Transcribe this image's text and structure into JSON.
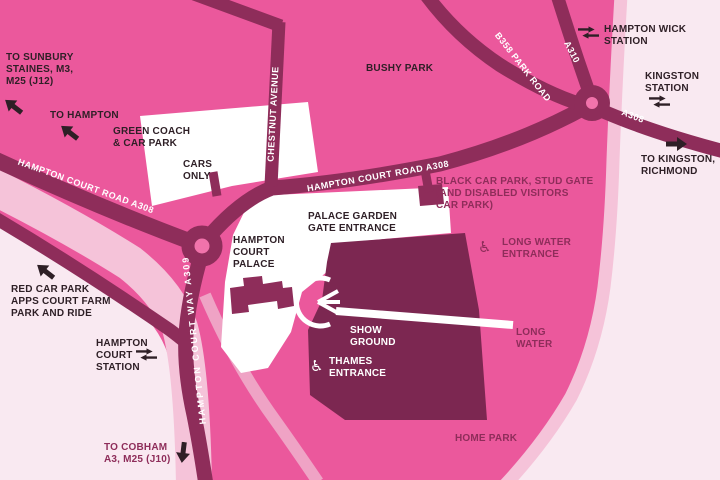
{
  "title": "Hampton Court Palace area map",
  "colors": {
    "pink": "#eb589c",
    "road": "#8e2d5a",
    "dark": "#7c2751",
    "lightband": "#f5c3d9",
    "medband": "#efa3c5",
    "verylight": "#f9e9f1",
    "rcenter": "#f173ab",
    "ink": "#2e1f26",
    "maroontext": "#8e2d5a"
  },
  "icons": {
    "wheelchair": "♿"
  },
  "labels": {
    "to_sunbury": {
      "l1": "TO SUNBURY",
      "l2": "STAINES, M3,",
      "l3": "M25 (J12)"
    },
    "to_hampton": {
      "l1": "TO HAMPTON"
    },
    "green_coach": {
      "l1": "GREEN COACH",
      "l2": "& CAR PARK"
    },
    "cars_only": {
      "l1": "CARS",
      "l2": "ONLY"
    },
    "bushy_park": {
      "l1": "BUSHY PARK"
    },
    "hampton_wick": {
      "l1": "HAMPTON WICK",
      "l2": "STATION"
    },
    "kingston_station": {
      "l1": "KINGSTON",
      "l2": "STATION"
    },
    "to_kingston": {
      "l1": "TO KINGSTON,",
      "l2": "RICHMOND"
    },
    "black_car_park": {
      "l1": "BLACK CAR PARK, STUD GATE",
      "l2": "(AND DISABLED VISITORS",
      "l3": "CAR PARK)"
    },
    "palace_garden": {
      "l1": "PALACE GARDEN",
      "l2": "GATE ENTRANCE"
    },
    "palace": {
      "l1": "HAMPTON",
      "l2": "COURT",
      "l3": "PALACE"
    },
    "long_water_entrance": {
      "l1": "LONG WATER",
      "l2": "ENTRANCE"
    },
    "red_car_park": {
      "l1": "RED CAR PARK",
      "l2": "APPS COURT FARM",
      "l3": "PARK AND RIDE"
    },
    "hc_station": {
      "l1": "HAMPTON",
      "l2": "COURT",
      "l3": "STATION"
    },
    "show_ground": {
      "l1": "SHOW",
      "l2": "GROUND"
    },
    "thames_entrance": {
      "l1": "THAMES",
      "l2": "ENTRANCE"
    },
    "long_water": {
      "l1": "LONG",
      "l2": "WATER"
    },
    "home_park": {
      "l1": "HOME PARK"
    },
    "to_cobham": {
      "l1": "TO COBHAM",
      "l2": "A3, M25 (J10)"
    },
    "roads": {
      "a308_west": "HAMPTON COURT ROAD A308",
      "a308_mid": "HAMPTON COURT ROAD A308",
      "chestnut": "CHESTNUT AVENUE",
      "b358": "B358 PARK ROAD",
      "a310": "A310",
      "a308_east": "A308",
      "a309": "HAMPTON COURT WAY A309"
    }
  }
}
